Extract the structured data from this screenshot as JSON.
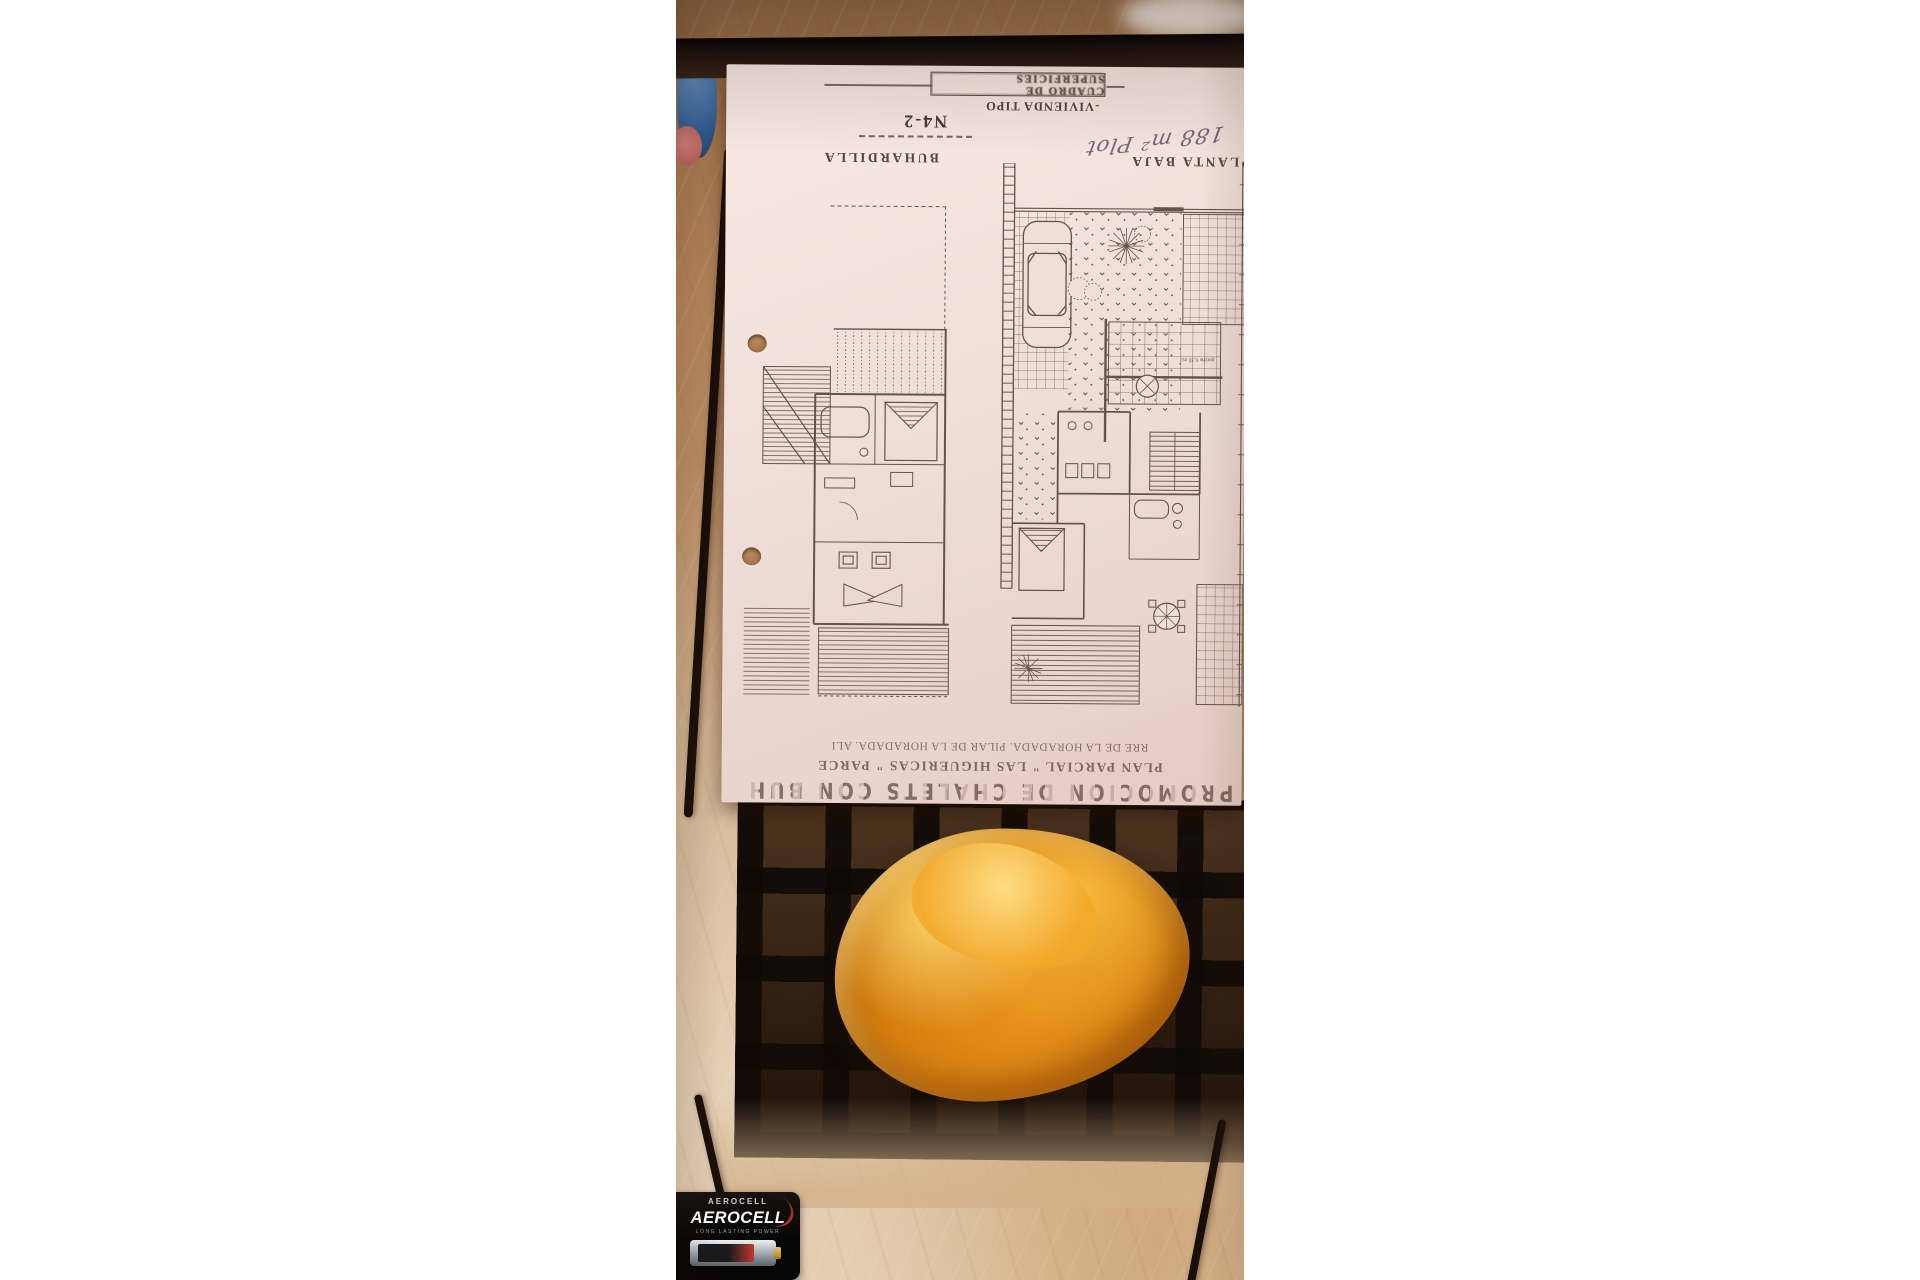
{
  "scene": {
    "description": "Photograph of an upside-down architect floor-plan sheet lying on a glass/wire lattice table over marble tiles, with an orange cloth under the table and a battery blister pack at bottom left",
    "colors": {
      "marble_tile": "#c49a70",
      "marble_light": "#e2cba8",
      "paper": "#f0ded8",
      "ink": "#55433b",
      "lattice_metal": "#1a100a",
      "cloth_orange": "#e8931b",
      "cloth_highlight": "#fbd46a",
      "battery_black": "#0c0a09",
      "battery_red": "#c03a2b",
      "handwriting_pen": "#59536b"
    }
  },
  "document": {
    "surface_box_label": "CUADRO DE SUPERFICIES",
    "dwelling_type_label": "-VIVIENDA TIPO",
    "type_code": "N4-2",
    "plan_left_label": "BUHARDILLA",
    "plan_right_label": "PLANTA BAJA",
    "handwriting_note": "188 m² Plot",
    "porch_annotation": "porche 6.35 m2",
    "stamp_line_big": "PROMOCION DE CHALETS CON BUHARD",
    "stamp_line_mid": "PLAN PARCIAL \" LAS HIGUERICAS \" PARCE",
    "stamp_line_small": "RRE DE LA HORADADA. PILAR DE LA HORADADA. ALI"
  },
  "battery": {
    "brand_small": "AEROCELL",
    "brand_large": "AEROCELL",
    "tagline": "LONG LASTING POWER"
  }
}
